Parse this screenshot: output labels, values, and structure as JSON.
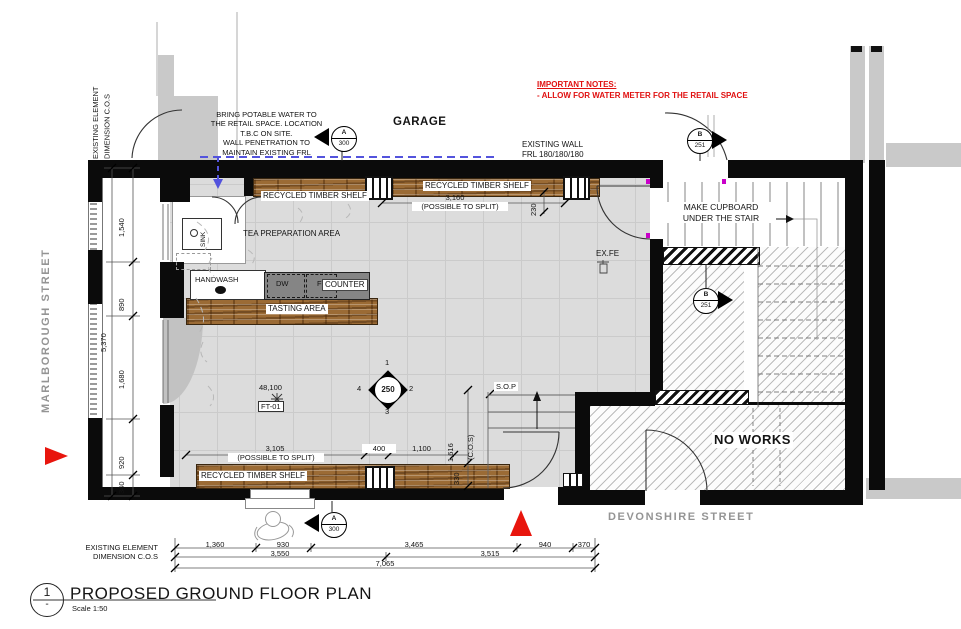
{
  "title_block": {
    "drawing_number": "1",
    "revision": "-",
    "title": "PROPOSED GROUND FLOOR PLAN",
    "scale": "Scale 1:50"
  },
  "streets": {
    "left": "MARLBOROUGH STREET",
    "bottom": "DEVONSHIRE STREET"
  },
  "notes": {
    "important_title": "IMPORTANT NOTES:",
    "important_body": "- ALLOW FOR WATER METER FOR THE RETAIL SPACE",
    "potable_water": "BRING POTABLE WATER TO\nTHE RETAIL SPACE. LOCATION\nT.B.C ON SITE.\nWALL PENETRATION TO\nMAINTAIN EXISTING FRL",
    "existing_wall": "EXISTING WALL\nFRL 180/180/180",
    "make_cupboard": "MAKE CUPBOARD\nUNDER THE STAIR",
    "existing_element_top": "EXISTING ELEMENT\nDIMENSION C.O.S",
    "existing_element_bottom": "EXISTING ELEMENT\nDIMENSION C.O.S"
  },
  "areas": {
    "garage": "GARAGE",
    "tea_preparation": "TEA PREPARATION AREA",
    "tasting": "TASTING AREA",
    "no_works": "NO WORKS",
    "handwash": "HANDWASH",
    "counter": "COUNTER",
    "dishwasher": "DW",
    "fridge": "F",
    "sink": "SINK",
    "shelf_top_left": "RECYCLED TIMBER SHELF",
    "shelf_top_right": "RECYCLED TIMBER SHELF",
    "shelf_bottom": "RECYCLED TIMBER SHELF",
    "sop": "S.O.P",
    "ex_fe": "EX.FE",
    "finish_tag": "FT-01",
    "level": "48,100"
  },
  "markers": {
    "section_a": {
      "letter": "A",
      "sheet": "300"
    },
    "section_b": {
      "letter": "B",
      "sheet": "251"
    },
    "grid_diamond": {
      "center": "250",
      "n1": "1",
      "n2": "2",
      "n3": "3",
      "n4": "4"
    }
  },
  "dimensions": {
    "left_chain": [
      "1,540",
      "890",
      "1,680",
      "920",
      "340"
    ],
    "left_overall": "5,370",
    "top_shelf": "3,160",
    "top_shelf_note": "(POSSIBLE TO SPLIT)",
    "top_shelf_depth": "230",
    "bottom_shelf": "3,105",
    "bottom_shelf_note": "(POSSIBLE TO SPLIT)",
    "dim_400": "400",
    "dim_1100": "1,100",
    "dim_1616": "1,616",
    "dim_1616_note": "(C.O.S)",
    "dim_330": "330",
    "bottom_chain": [
      "1,360",
      "930",
      "3,465",
      "940",
      "370"
    ],
    "bottom_subtotals": [
      "3,550",
      "3,515"
    ],
    "bottom_overall": "7,065"
  },
  "colors": {
    "accent_red": "#e01010",
    "water_line_blue": "#5353dd",
    "timber": "#9b6b35",
    "floor_gray": "#dcdcdc",
    "wall_black": "#0b0b0b",
    "street_text_gray": "#949494"
  }
}
